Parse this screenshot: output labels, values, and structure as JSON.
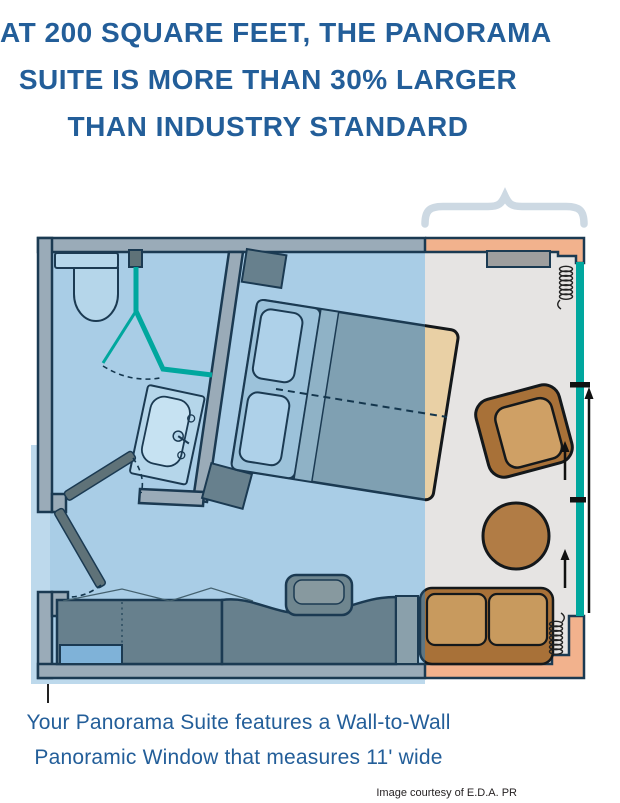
{
  "header": {
    "lines": [
      "AT 200 SQUARE FEET, THE PANORAMA",
      "SUITE IS MORE THAN 30% LARGER",
      "THAN INDUSTRY STANDARD"
    ]
  },
  "caption": {
    "lines": [
      "Your Panorama Suite features a Wall-to-Wall",
      "Panoramic Window that measures 11' wide"
    ]
  },
  "credit": "Image courtesy of E.D.A. PR",
  "colors": {
    "headline_blue": "#235e99",
    "credit_black": "#231f20",
    "overlay_blue": "#a9cde6",
    "overlay_edge": "#bdd9ec",
    "floor_gray": "#e6e4e3",
    "wall_peach": "#f2b28d",
    "wall_slate": "#9aabb8",
    "window_teal": "#00a79e",
    "outline_navy": "#1b3a52",
    "dark_fixture": "#67808d",
    "door_gray": "#5f7278",
    "light_blue": "#b5d6ea",
    "sink_blue": "#c6e2f2",
    "bed_slate": "#7fa0b2",
    "bed_head_slate": "#9cc2da",
    "bed_seam_slate": "#8fb2c6",
    "pillow_blue": "#aed1e9",
    "bed_beige": "#e9d0a5",
    "furniture_brown": "#a87138",
    "cushion_tan": "#c89a5e",
    "chair_seat": "#cfa065",
    "table_brown": "#b17c45",
    "console_gray": "#9e9e9e",
    "slate_sofa": "#5e7683",
    "slate_cushion": "#7b95a3",
    "chair_slate": "#6f868f",
    "chair_slate_light": "#87999f",
    "desk_light": "#8aa0ab",
    "safe_blue": "#7fb2d8",
    "brace_gray": "#cdd9e3",
    "arrow_black": "#111111",
    "dash_navy": "#14364d"
  }
}
